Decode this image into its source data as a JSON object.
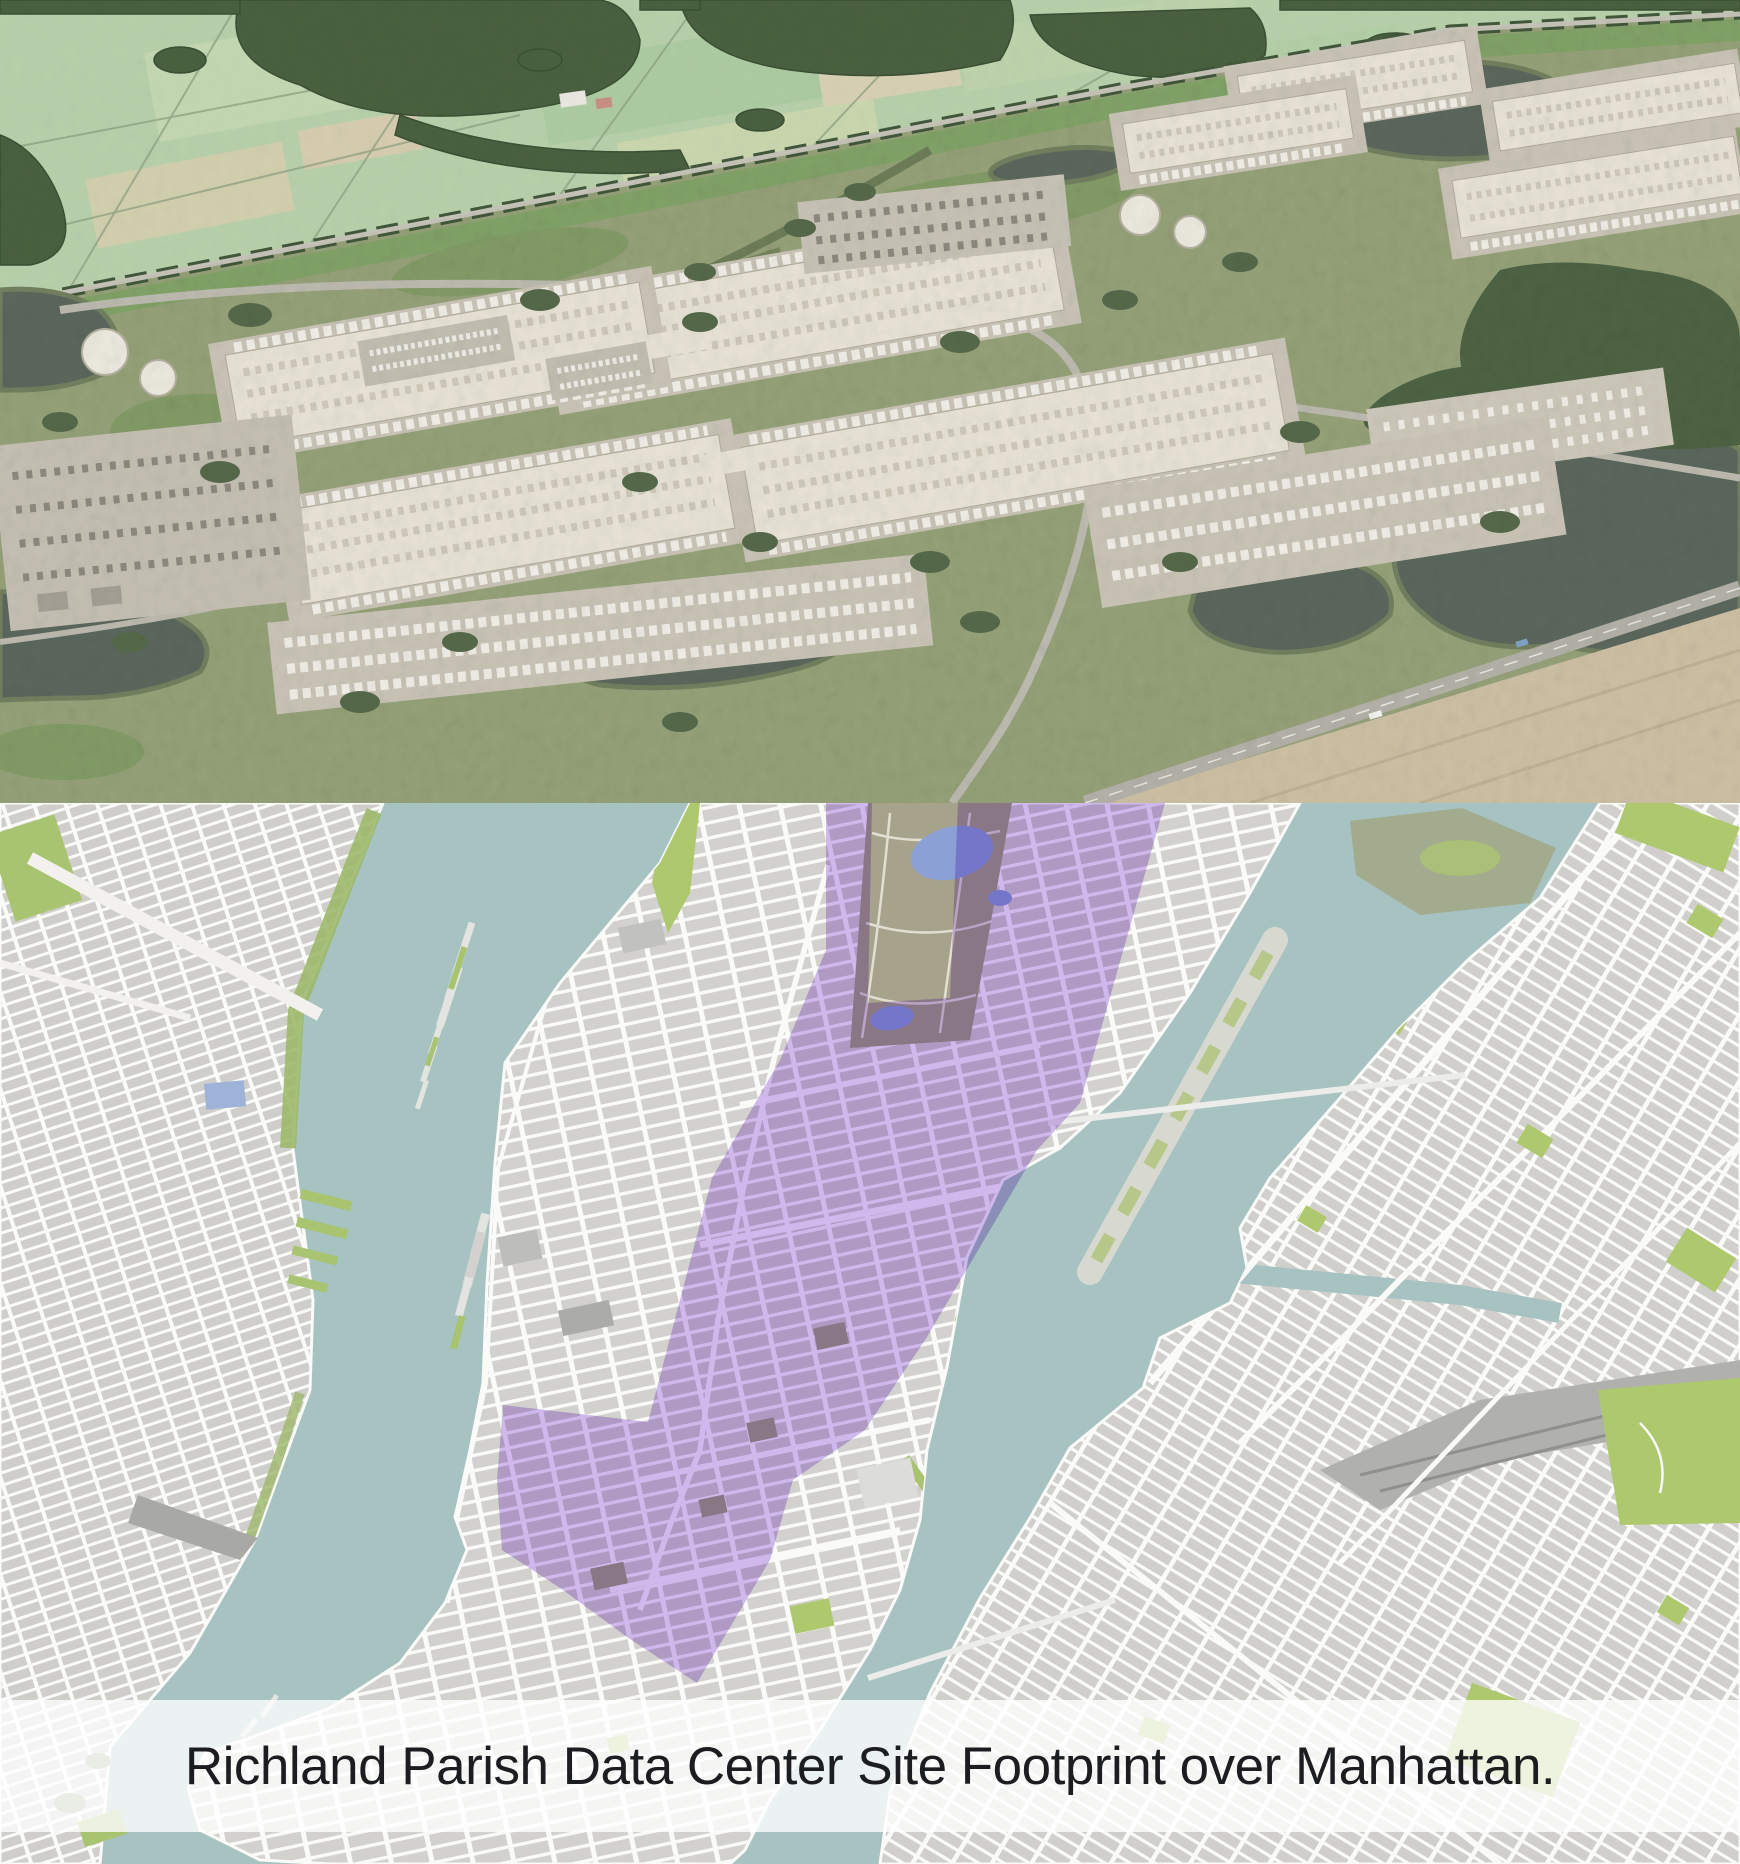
{
  "caption": {
    "text": "Richland Parish Data Center Site Footprint over Manhattan."
  },
  "colors": {
    "footprint_purple": "#cbb0f0",
    "water_teal": "#a6c2c1",
    "map_street_white": "#fafaf8",
    "map_block_gray": "#d2d1ce",
    "map_green": "#aec86e",
    "central_park_olive": "#a7a28c",
    "reservoir_blue": "#8ba0d4",
    "caption_text": "#1b1d20",
    "caption_background": "rgba(255,255,255,0.78)",
    "render_field_green": "#b7d0aa",
    "render_scrub_green": "#95a178",
    "render_forest_green": "#49603f",
    "render_building_beige": "#e8e3d6",
    "render_pond_dark": "#5b675c",
    "render_dirt_tan": "#cdc0a4"
  }
}
